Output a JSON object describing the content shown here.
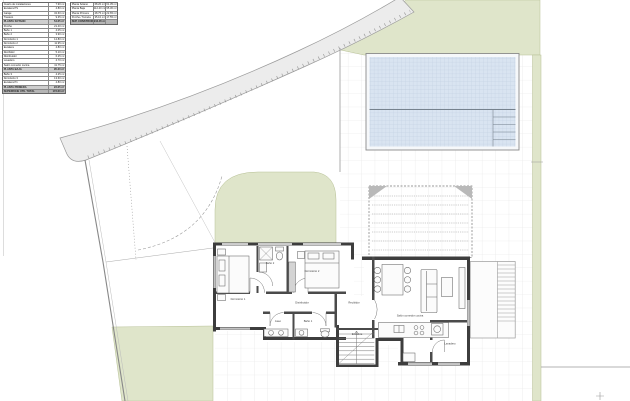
{
  "colors": {
    "green": "#dfe5ca",
    "green_border": "#b7c096",
    "pool_water": "#d9e4f1",
    "pool_grid": "#bccade",
    "tile_grid": "#e3e3e3",
    "wall": "#3d3d3d",
    "road": "#ececec",
    "line": "#9a9a9a"
  },
  "tables": {
    "areas": {
      "rows": [
        {
          "label": "Cuarto de instalaciones",
          "value": "7.90 m²"
        },
        {
          "label": "Escalera PS",
          "value": "4.80 m²"
        },
        {
          "label": "Garaje",
          "value": "32.60 m²"
        },
        {
          "label": "Trastero",
          "value": "9.35 m²"
        },
        {
          "label": "PLANTA SÓTANO",
          "value": "54.65 m²",
          "type": "subtotal"
        },
        {
          "label": "Porche",
          "value": "21.40 m²"
        },
        {
          "label": "Baño 1",
          "value": "4.05 m²"
        },
        {
          "label": "Baño 2",
          "value": "3.90 m²"
        },
        {
          "label": "Dormitorio 1",
          "value": "12.80 m²"
        },
        {
          "label": "Dormitorio 2",
          "value": "11.95 m²"
        },
        {
          "label": "Escalera",
          "value": "4.80 m²"
        },
        {
          "label": "Recibidor",
          "value": "5.10 m²"
        },
        {
          "label": "Distribuidor",
          "value": "6.25 m²"
        },
        {
          "label": "Lavadero",
          "value": "4.70 m²"
        },
        {
          "label": "Salón comedor cocina",
          "value": "41.75 m²"
        },
        {
          "label": "PLANTA BAJA",
          "value": "95.30 m²",
          "type": "subtotal"
        },
        {
          "label": "Baño 3",
          "value": "4.25 m²"
        },
        {
          "label": "Dormitorio 3",
          "value": "13.60 m²"
        },
        {
          "label": "Escalera P1",
          "value": "4.80 m²"
        },
        {
          "label": "PLANTA PRIMERA",
          "value": "22.65 m²",
          "type": "subtotal"
        },
        {
          "label": "SUPERFICIE ÚTIL TOTAL",
          "value": "172.60 m²",
          "type": "total"
        }
      ]
    },
    "built": {
      "rows": [
        {
          "label": "Planta Sótano",
          "v1": "68.20 m²",
          "v2": "61.35 m²"
        },
        {
          "label": "Planta Baja",
          "v1": "112.40 m²",
          "v2": "95.30 m²"
        },
        {
          "label": "Planta Primera",
          "v1": "28.75 m²",
          "v2": "22.65 m²"
        },
        {
          "label": "Porche / Terraza",
          "v1": "35.10 m²",
          "v2": "17.55 m²"
        },
        {
          "label": "SUP. CONSTRUIDA TOTAL",
          "v1": "244.45 m²",
          "v2": "",
          "type": "total"
        }
      ]
    }
  },
  "rooms": {
    "dormitorio1": "Dormitorio 1",
    "dormitorio2": "Dormitorio 2",
    "bano2": "Baño 2",
    "bano1": "Baño 1",
    "aseo": "Aseo",
    "distribuidor": "Distribuidor",
    "recibidor": "Recibidor",
    "escalera": "Escalera",
    "lavadero": "Lavadero",
    "salon": "Salón comedor cocina"
  }
}
